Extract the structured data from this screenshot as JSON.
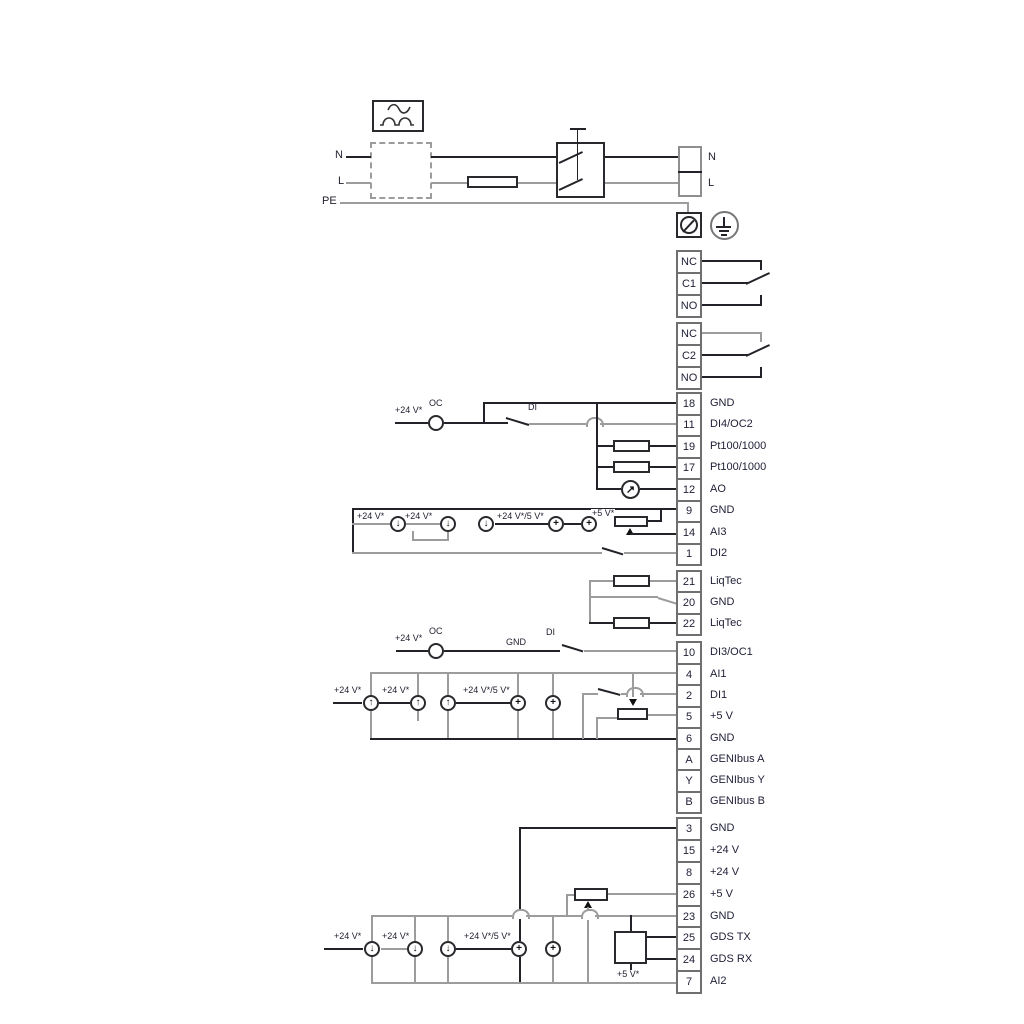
{
  "title": "Pump wiring diagram",
  "colors": {
    "line_black": "#222228",
    "line_gray": "#9c9c9c",
    "text": "#1e1e36"
  },
  "power": {
    "n_left": "N",
    "l_left": "L",
    "pe": "PE",
    "n_right": "N",
    "l_right": "L"
  },
  "labels": {
    "v24": "+24 V*",
    "v24v5": "+24 V*/5 V*",
    "v5": "+5 V*",
    "oc": "OC",
    "di": "DI",
    "gnd": "GND"
  },
  "icons": {
    "arrow_down": "↓",
    "arrow_up": "↑",
    "plus": "+",
    "meter_arrow": "↗"
  },
  "terminal_groups": [
    {
      "id": "relay-1",
      "cells": [
        {
          "num": "NC",
          "label": ""
        },
        {
          "num": "C1",
          "label": ""
        },
        {
          "num": "NO",
          "label": ""
        }
      ]
    },
    {
      "id": "relay-2",
      "cells": [
        {
          "num": "NC",
          "label": ""
        },
        {
          "num": "C2",
          "label": ""
        },
        {
          "num": "NO",
          "label": ""
        }
      ]
    },
    {
      "id": "io-upper",
      "cells": [
        {
          "num": "18",
          "label": "GND"
        },
        {
          "num": "11",
          "label": "DI4/OC2"
        },
        {
          "num": "19",
          "label": "Pt100/1000"
        },
        {
          "num": "17",
          "label": "Pt100/1000"
        },
        {
          "num": "12",
          "label": "AO"
        },
        {
          "num": "9",
          "label": "GND"
        },
        {
          "num": "14",
          "label": "AI3"
        },
        {
          "num": "1",
          "label": "DI2"
        }
      ]
    },
    {
      "id": "liqtec",
      "cells": [
        {
          "num": "21",
          "label": "LiqTec"
        },
        {
          "num": "20",
          "label": "GND"
        },
        {
          "num": "22",
          "label": "LiqTec"
        }
      ]
    },
    {
      "id": "di3",
      "cells": [
        {
          "num": "10",
          "label": "DI3/OC1"
        }
      ]
    },
    {
      "id": "io-mid",
      "cells": [
        {
          "num": "4",
          "label": "AI1"
        },
        {
          "num": "2",
          "label": "DI1"
        },
        {
          "num": "5",
          "label": "+5 V"
        },
        {
          "num": "6",
          "label": "GND"
        },
        {
          "num": "A",
          "label": "GENIbus A"
        },
        {
          "num": "Y",
          "label": "GENIbus Y"
        },
        {
          "num": "B",
          "label": "GENIbus B"
        }
      ]
    },
    {
      "id": "io-lower",
      "cells": [
        {
          "num": "3",
          "label": "GND"
        },
        {
          "num": "15",
          "label": "+24 V"
        },
        {
          "num": "8",
          "label": "+24 V"
        },
        {
          "num": "26",
          "label": "+5 V"
        },
        {
          "num": "23",
          "label": "GND"
        },
        {
          "num": "25",
          "label": "GDS TX"
        },
        {
          "num": "24",
          "label": "GDS RX"
        },
        {
          "num": "7",
          "label": "AI2"
        }
      ]
    }
  ]
}
